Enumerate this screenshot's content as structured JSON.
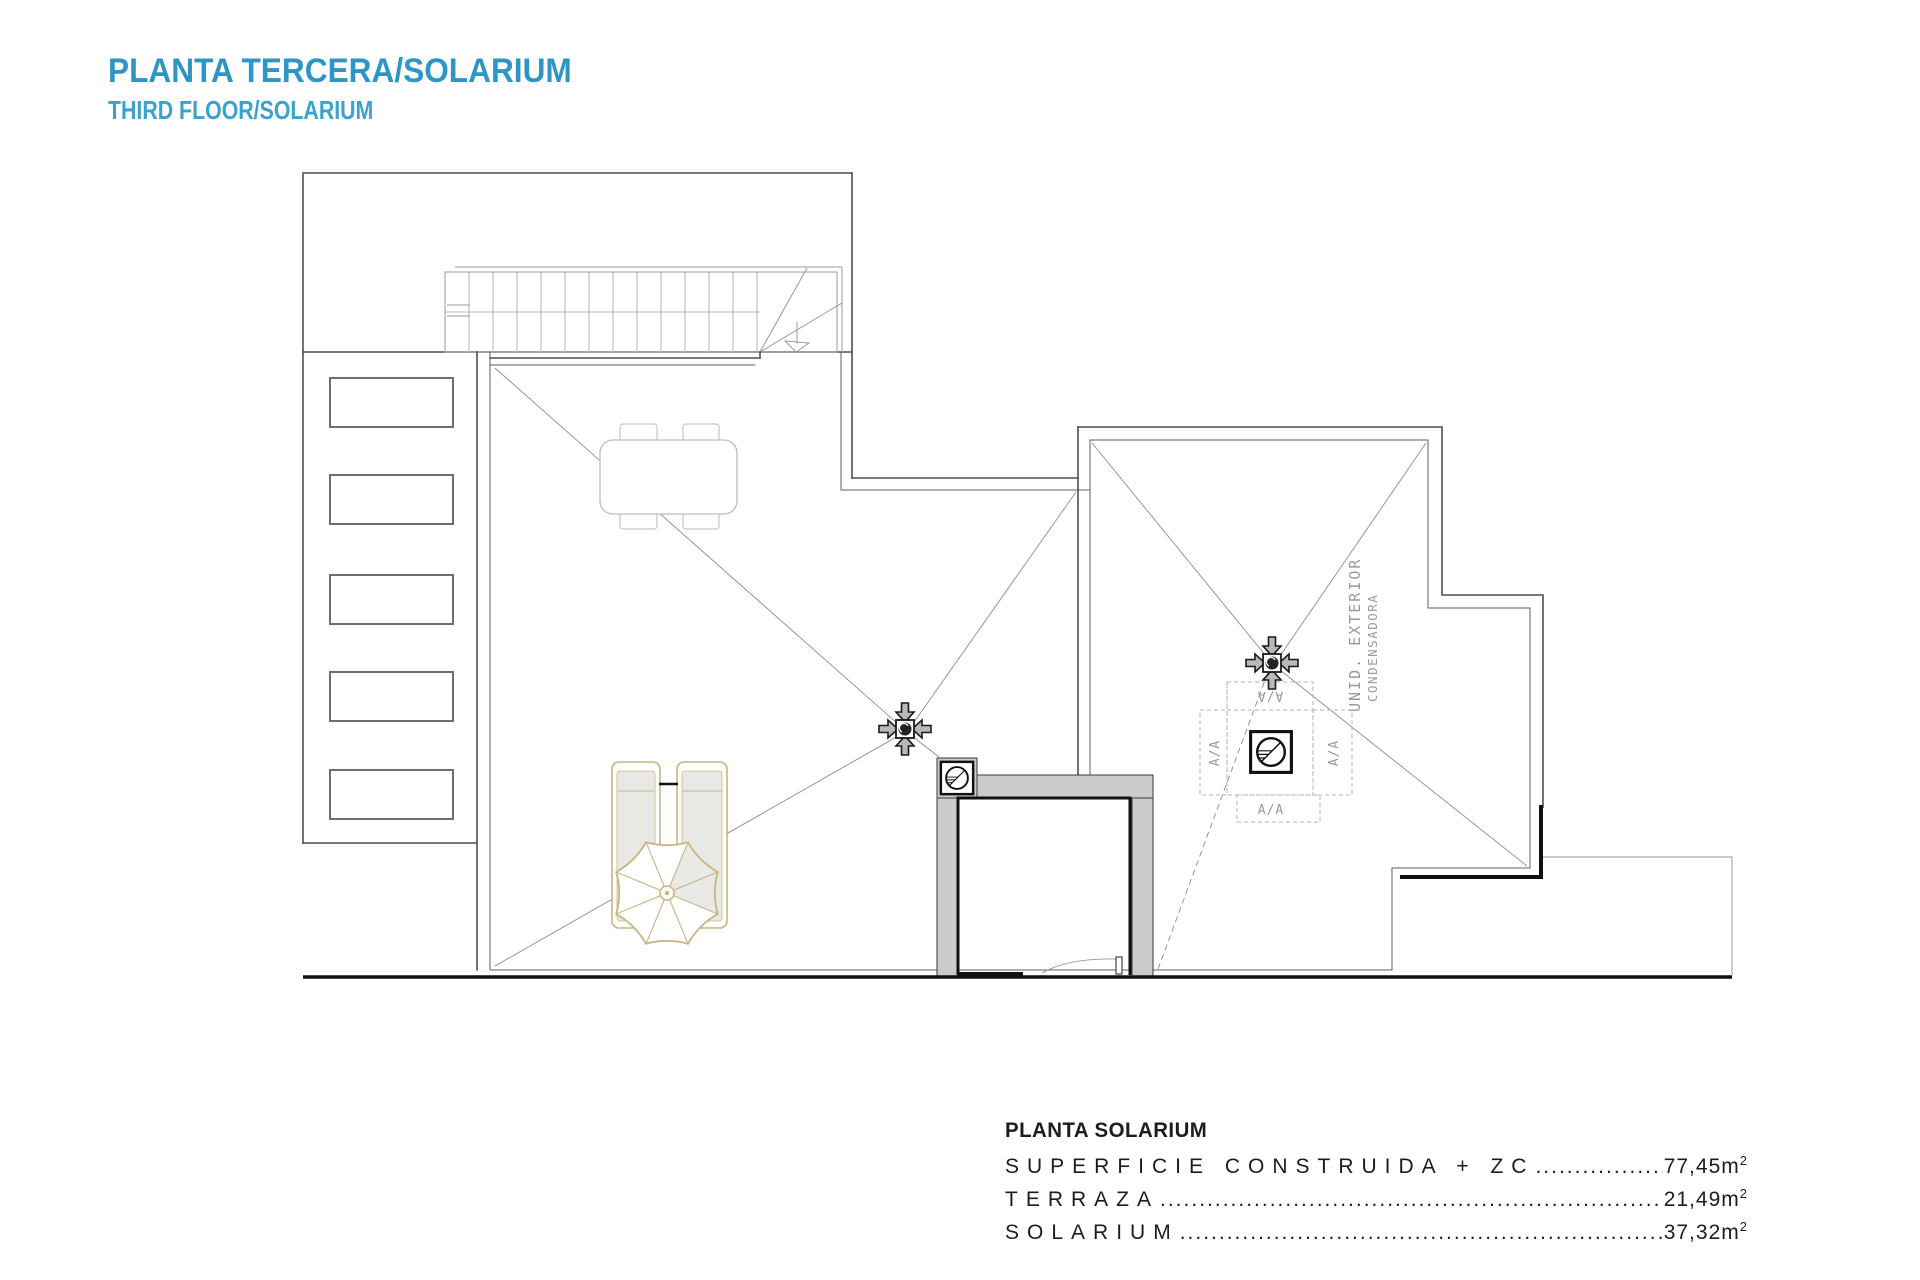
{
  "theme": {
    "accent": "#2E96C6",
    "accent_light": "#3AA2CE",
    "wall_fill": "#CBCBCB",
    "furniture_tan": "#C7B582"
  },
  "header": {
    "title": "PLANTA TERCERA/SOLARIUM",
    "subtitle": "THIRD FLOOR/SOLARIUM"
  },
  "plan": {
    "ac_unit": {
      "label_line1": "UNID. EXTERIOR",
      "label_line2": "CONDENSADORA",
      "flap_top": "A/A",
      "flap_left": "A/A",
      "flap_right": "A/A",
      "flap_bottom": "A/A"
    }
  },
  "summary": {
    "title": "PLANTA SOLARIUM",
    "rows": [
      {
        "label": "SUPERFICIE CONSTRUIDA + ZC",
        "value": "77,45",
        "unit": "m",
        "sup": "2"
      },
      {
        "label": "TERRAZA",
        "value": "21,49",
        "unit": "m",
        "sup": "2"
      },
      {
        "label": "SOLARIUM",
        "value": "37,32",
        "unit": "m",
        "sup": "2"
      }
    ]
  }
}
